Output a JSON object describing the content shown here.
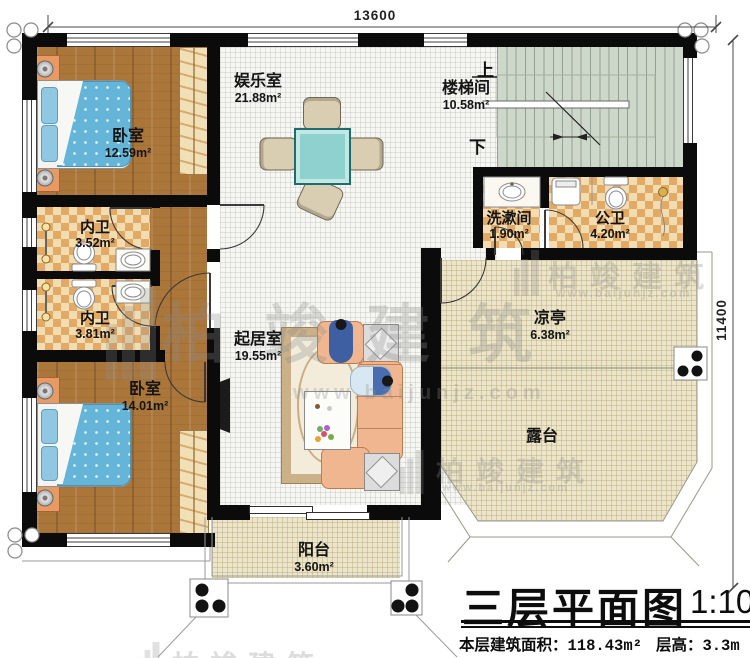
{
  "plan": {
    "dim_top": "13600",
    "dim_right": "11400",
    "stair_up": "上",
    "stair_down": "下",
    "rooms": {
      "bedroom1": {
        "name": "卧室",
        "area": "12.59m²"
      },
      "innerbath1": {
        "name": "内卫",
        "area": "3.52m²"
      },
      "innerbath2": {
        "name": "内卫",
        "area": "3.81m²"
      },
      "bedroom2": {
        "name": "卧室",
        "area": "14.01m²"
      },
      "entertainment": {
        "name": "娱乐室",
        "area": "21.88m²"
      },
      "stairwell": {
        "name": "楼梯间",
        "area": "10.58m²"
      },
      "washroom": {
        "name": "洗漱间",
        "area": "1.90m²"
      },
      "publicbath": {
        "name": "公卫",
        "area": "4.20m²"
      },
      "pavilion": {
        "name": "凉亭",
        "area": "6.38m²"
      },
      "terrace": {
        "name": "露台"
      },
      "livingroom": {
        "name": "起居室",
        "area": "19.55m²"
      },
      "balcony": {
        "name": "阳台",
        "area": "3.60m²"
      }
    }
  },
  "titleblock": {
    "title": "三层平面图",
    "scale": "1:100",
    "area_label": "本层建筑面积：",
    "area_value": "118.43m²",
    "height_label": "层高：",
    "height_value": "3.3m"
  },
  "watermark": {
    "name": "柏竣建筑",
    "url": "www.baijunjz.com"
  },
  "colors": {
    "wall": "#0b0b0b",
    "wood": "#ab763a",
    "tile_light": "#f3ddb0",
    "tile_dark": "#e2aa67",
    "stair": "#ced8ca",
    "terrace": "#ede5c9",
    "bed": "#64b5d8",
    "sofa": "#f0b68f",
    "table": "#8ed1cf"
  }
}
